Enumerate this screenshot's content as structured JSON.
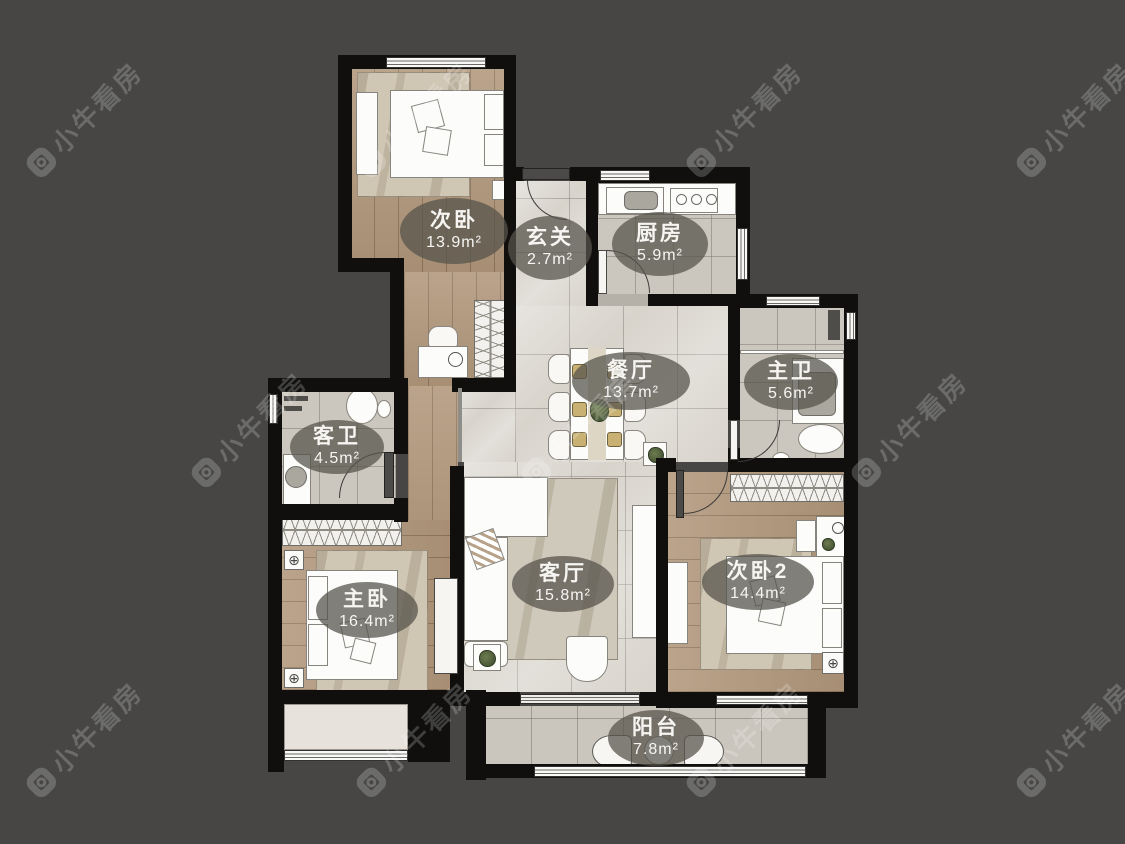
{
  "watermark": {
    "brand": "小牛看房"
  },
  "icons": {
    "fixture": "⊕"
  },
  "rooms": [
    {
      "name": "次卧",
      "area": "13.9m²"
    },
    {
      "name": "玄关",
      "area": "2.7m²"
    },
    {
      "name": "厨房",
      "area": "5.9m²"
    },
    {
      "name": "餐厅",
      "area": "13.7m²"
    },
    {
      "name": "主卫",
      "area": "5.6m²"
    },
    {
      "name": "客卫",
      "area": "4.5m²"
    },
    {
      "name": "主卧",
      "area": "16.4m²"
    },
    {
      "name": "客厅",
      "area": "15.8m²"
    },
    {
      "name": "次卧2",
      "area": "14.4m²"
    },
    {
      "name": "阳台",
      "area": "7.8m²"
    }
  ],
  "colors": {
    "background": "#474645",
    "wall": "#100f0e",
    "wood": "#b1977b",
    "tile_light": "#d8d4cc",
    "tile_grey": "#ccc7be",
    "label_bg": "rgba(86,83,76,0.74)"
  }
}
